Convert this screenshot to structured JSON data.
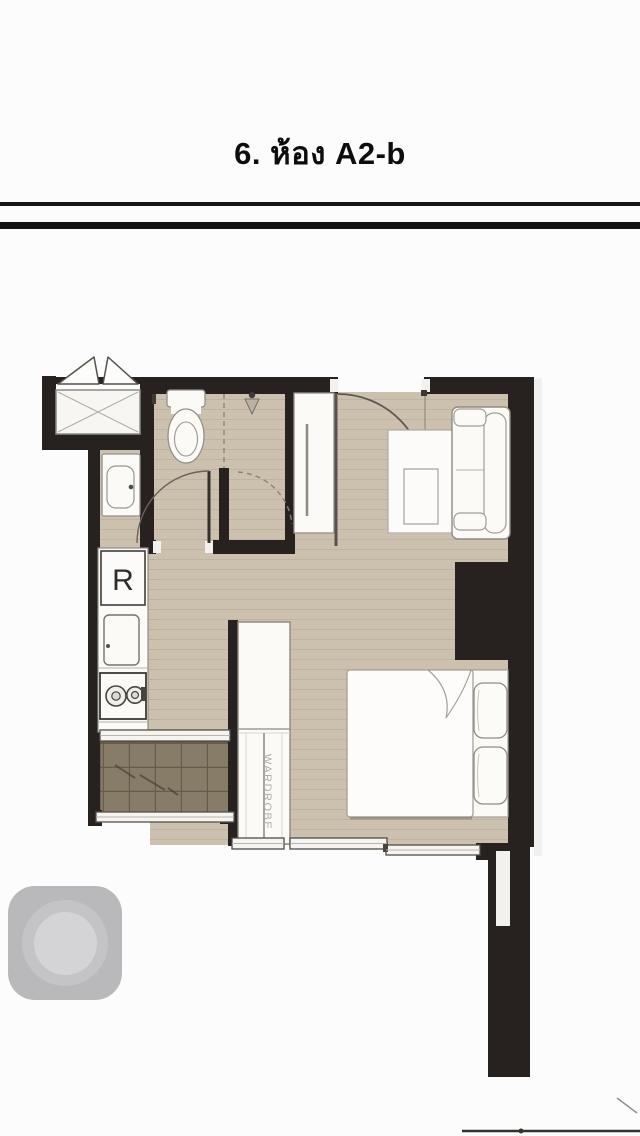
{
  "header": {
    "title": "6. ห้อง A2-b"
  },
  "floor_plan": {
    "fridge_label": "R",
    "wardrobe_label": "WARDROBE",
    "colors": {
      "wall": "#272220",
      "floor": "#cbc1ae",
      "floor_plank_line": "#b5a892",
      "balcony_floor": "#877c68",
      "balcony_tile_line": "#665c4c",
      "furniture_fill": "#fbfaf7",
      "furniture_outline": "#94908a",
      "door_arc": "#5d574f"
    }
  },
  "assistive_touch_button": {
    "outer_color": "#b9b9bb",
    "ring_color": "#c4c4c6",
    "inner_color": "#d4d4d6"
  }
}
